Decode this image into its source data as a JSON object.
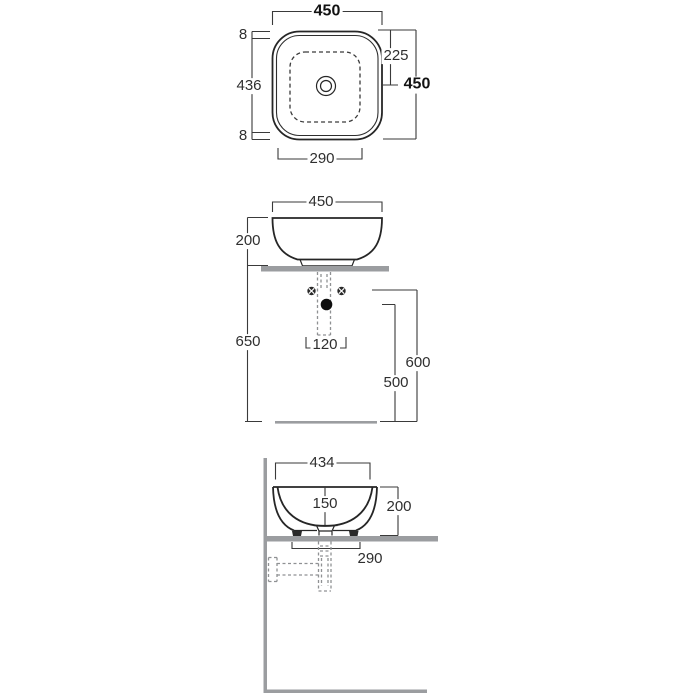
{
  "meta": {
    "type": "technical-dimension-drawing",
    "subject": "countertop washbasin with three orthographic views"
  },
  "colors": {
    "line": "#262626",
    "dimension_line": "#3a3a3a",
    "gray_surface": "#9b9da0",
    "text": "#2f2f2f"
  },
  "views": {
    "plan": {
      "name": "plan view (top)",
      "dims": {
        "overall_width": "450",
        "rim_top": "8",
        "inner_length": "436",
        "rim_bottom": "8",
        "drain_center": "225",
        "overall_depth": "450",
        "base_width": "290"
      }
    },
    "front": {
      "name": "front elevation",
      "dims": {
        "overall_width": "450",
        "basin_height": "200",
        "counter_height": "650",
        "drain_offset": "120",
        "fixing_height": "600",
        "supply_height": "500"
      }
    },
    "side": {
      "name": "side section",
      "dims": {
        "inner_width": "434",
        "bowl_depth": "150",
        "basin_height": "200",
        "drain_wall_distance": "290"
      }
    }
  }
}
